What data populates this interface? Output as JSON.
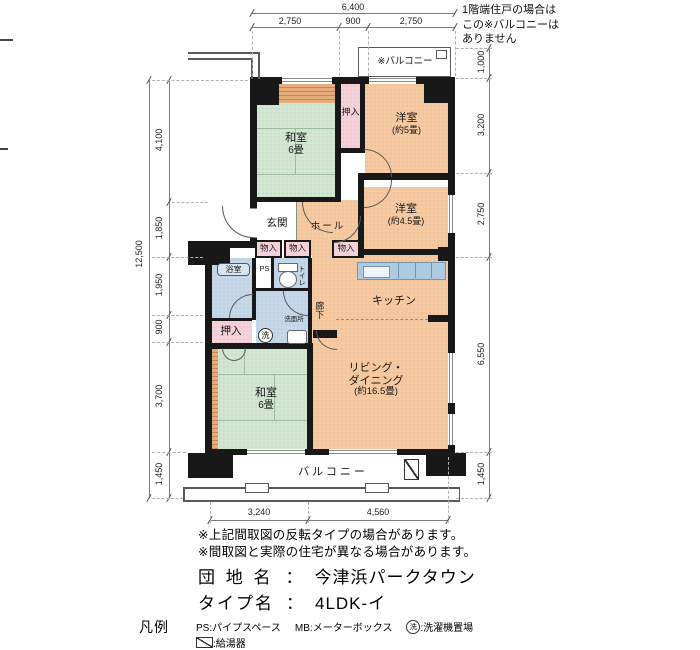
{
  "top_note": {
    "lines": [
      "1階端住戸の場合は",
      "この※バルコニーは",
      "ありません"
    ]
  },
  "dimensions": {
    "top": {
      "total": "6,400",
      "segments": [
        "2,750",
        "900",
        "2,750"
      ]
    },
    "left": {
      "total": "12,500",
      "segments": [
        "4,100",
        "1,850",
        "1,950",
        "900",
        "3,700",
        "1,450"
      ]
    },
    "right": {
      "segments": [
        "1,000",
        "3,200",
        "2,750",
        "6,550",
        "1,450"
      ]
    },
    "bottom": {
      "segments": [
        "3,240",
        "4,560"
      ]
    }
  },
  "rooms": {
    "washitsu_top": {
      "name": "和室",
      "size": "6畳"
    },
    "oshiire_top": "押入",
    "yoshitsu_5": {
      "name": "洋室",
      "size": "(約5畳)"
    },
    "yoshitsu_45": {
      "name": "洋室",
      "size": "(約4.5畳)"
    },
    "genkan": "玄関",
    "hall": "ホール",
    "mono_1": "物入",
    "mono_2": "物入",
    "mono_3": "物入",
    "yokushitsu": "浴室",
    "ps": "PS",
    "toilet": "トイレ",
    "senmenjo": "洗面所",
    "wash_circle": "洗",
    "oshiire_mid": "押入",
    "rouka": "廊下",
    "kitchen": "キッチン",
    "living": {
      "line1": "リビング・",
      "line2": "ダイニング",
      "size": "(約16.5畳)"
    },
    "washitsu_bottom": {
      "name": "和室",
      "size": "6畳"
    },
    "balcony_bottom": "バルコニー",
    "balcony_top": "※バルコニー"
  },
  "footer": {
    "notes": [
      "※上記間取図の反転タイプの場合があります。",
      "※間取図と実際の住宅が異なる場合があります。"
    ],
    "danchi": {
      "label": "団 地 名",
      "colon": "：",
      "value": "今津浜パークタウン"
    },
    "type": {
      "label": "タイプ名",
      "colon": "：",
      "value": "4LDK-イ"
    },
    "legend": {
      "title": "凡例",
      "ps": "PS:パイプスペース",
      "mb": "MB:メーターボックス",
      "wash_icon": "洗",
      "wash": ":洗濯機置場",
      "heater": ":給湯器"
    }
  }
}
